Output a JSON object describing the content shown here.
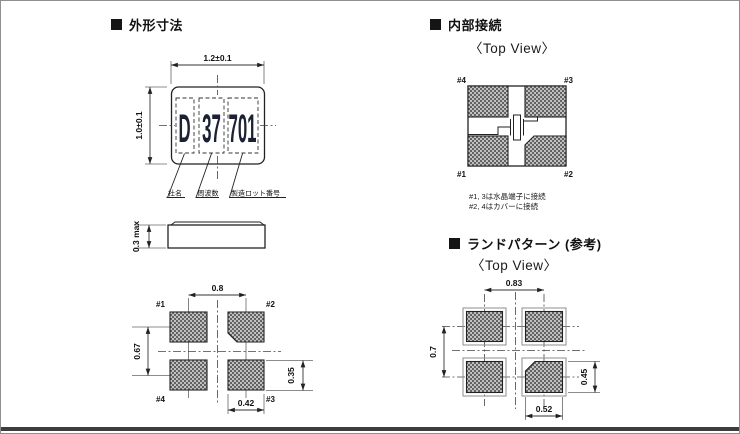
{
  "sections": {
    "outline": {
      "title": "外形寸法"
    },
    "internal": {
      "title": "内部接続",
      "top_view_label": "〈Top View〉",
      "notes": [
        "#1, 3は水晶端子に接続",
        "#2, 4はカバーに接続"
      ]
    },
    "land": {
      "title": "ランドパターン (参考)",
      "top_view_label": "〈Top View〉"
    }
  },
  "package": {
    "marking": {
      "company": "D",
      "frequency": "37",
      "lot": "701"
    },
    "marking_legend": {
      "company": "社名",
      "frequency": "周波数",
      "lot": "製造ロット番号"
    },
    "dims": {
      "width": "1.2±0.1",
      "height": "1.0±0.1",
      "thickness": "0.3 max"
    }
  },
  "bottom_view": {
    "pins": {
      "top_left": "#1",
      "top_right": "#2",
      "bottom_left": "#4",
      "bottom_right": "#3"
    },
    "dims": {
      "pitch_x": "0.8",
      "pitch_y": "0.67",
      "pad_height": "0.35",
      "pad_width": "0.42"
    }
  },
  "internal_view": {
    "pins": {
      "top_left": "#4",
      "top_right": "#3",
      "bottom_left": "#1",
      "bottom_right": "#2"
    }
  },
  "land_pattern": {
    "dims": {
      "pitch_x": "0.83",
      "pitch_y": "0.7",
      "pad_height": "0.45",
      "pad_width": "0.52"
    }
  },
  "colors": {
    "line": "#222222",
    "accent_bar": "#3d3d3d",
    "marking_text": "#1b2133"
  }
}
